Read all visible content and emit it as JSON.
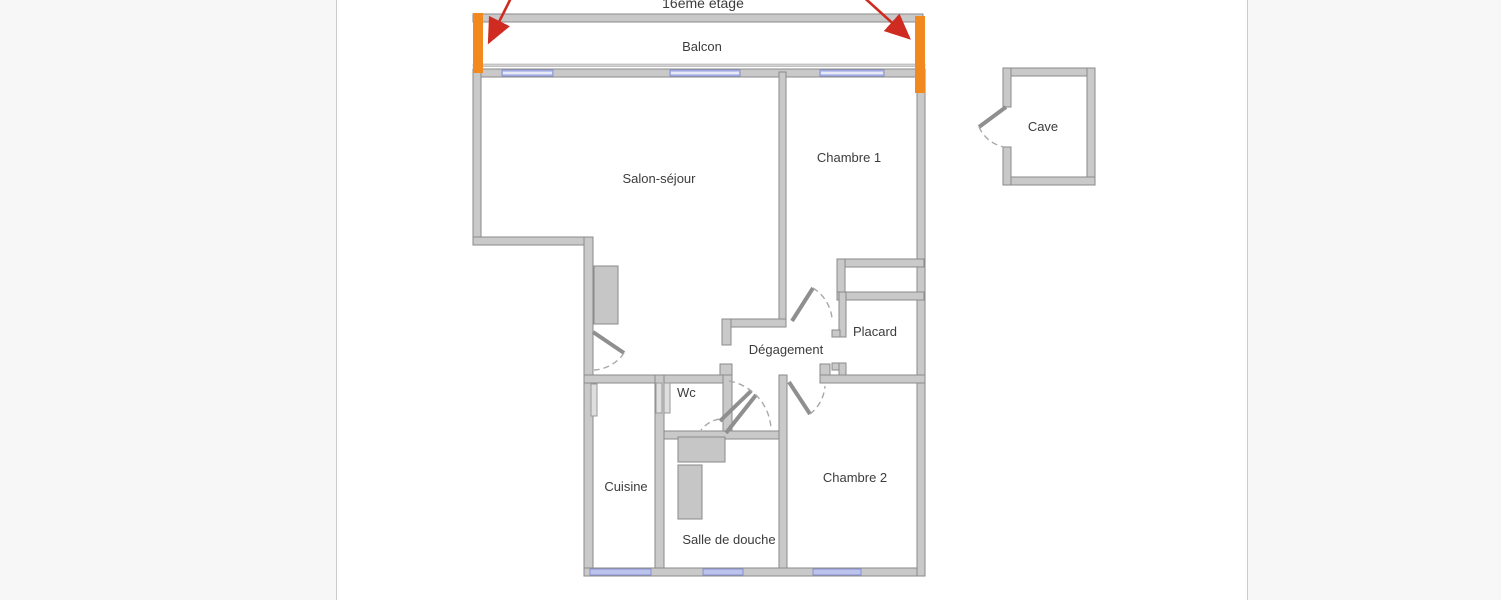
{
  "page": {
    "floor_label": "16ème étage"
  },
  "floorplan": {
    "rooms": [
      {
        "name": "balcon",
        "label": "Balcon"
      },
      {
        "name": "salon-sejour",
        "label": "Salon-séjour"
      },
      {
        "name": "chambre-1",
        "label": "Chambre 1"
      },
      {
        "name": "degagement",
        "label": "Dégagement"
      },
      {
        "name": "placard",
        "label": "Placard"
      },
      {
        "name": "wc",
        "label": "Wc"
      },
      {
        "name": "cuisine",
        "label": "Cuisine"
      },
      {
        "name": "salle-de-douche",
        "label": "Salle de douche"
      },
      {
        "name": "chambre-2",
        "label": "Chambre 2"
      },
      {
        "name": "cave",
        "label": "Cave"
      }
    ],
    "colors": {
      "wall_fill": "#c9c9c9",
      "wall_stroke": "#8a8a8a",
      "window": "#bcc4ee",
      "window_stroke": "#7b86c9",
      "highlight_orange": "#f2891f",
      "arrow_red": "#cf2b20",
      "text": "#3c3c3c",
      "page_bg": "#f7f7f7",
      "panel_bg": "#ffffff",
      "panel_border": "#cccccc"
    }
  }
}
